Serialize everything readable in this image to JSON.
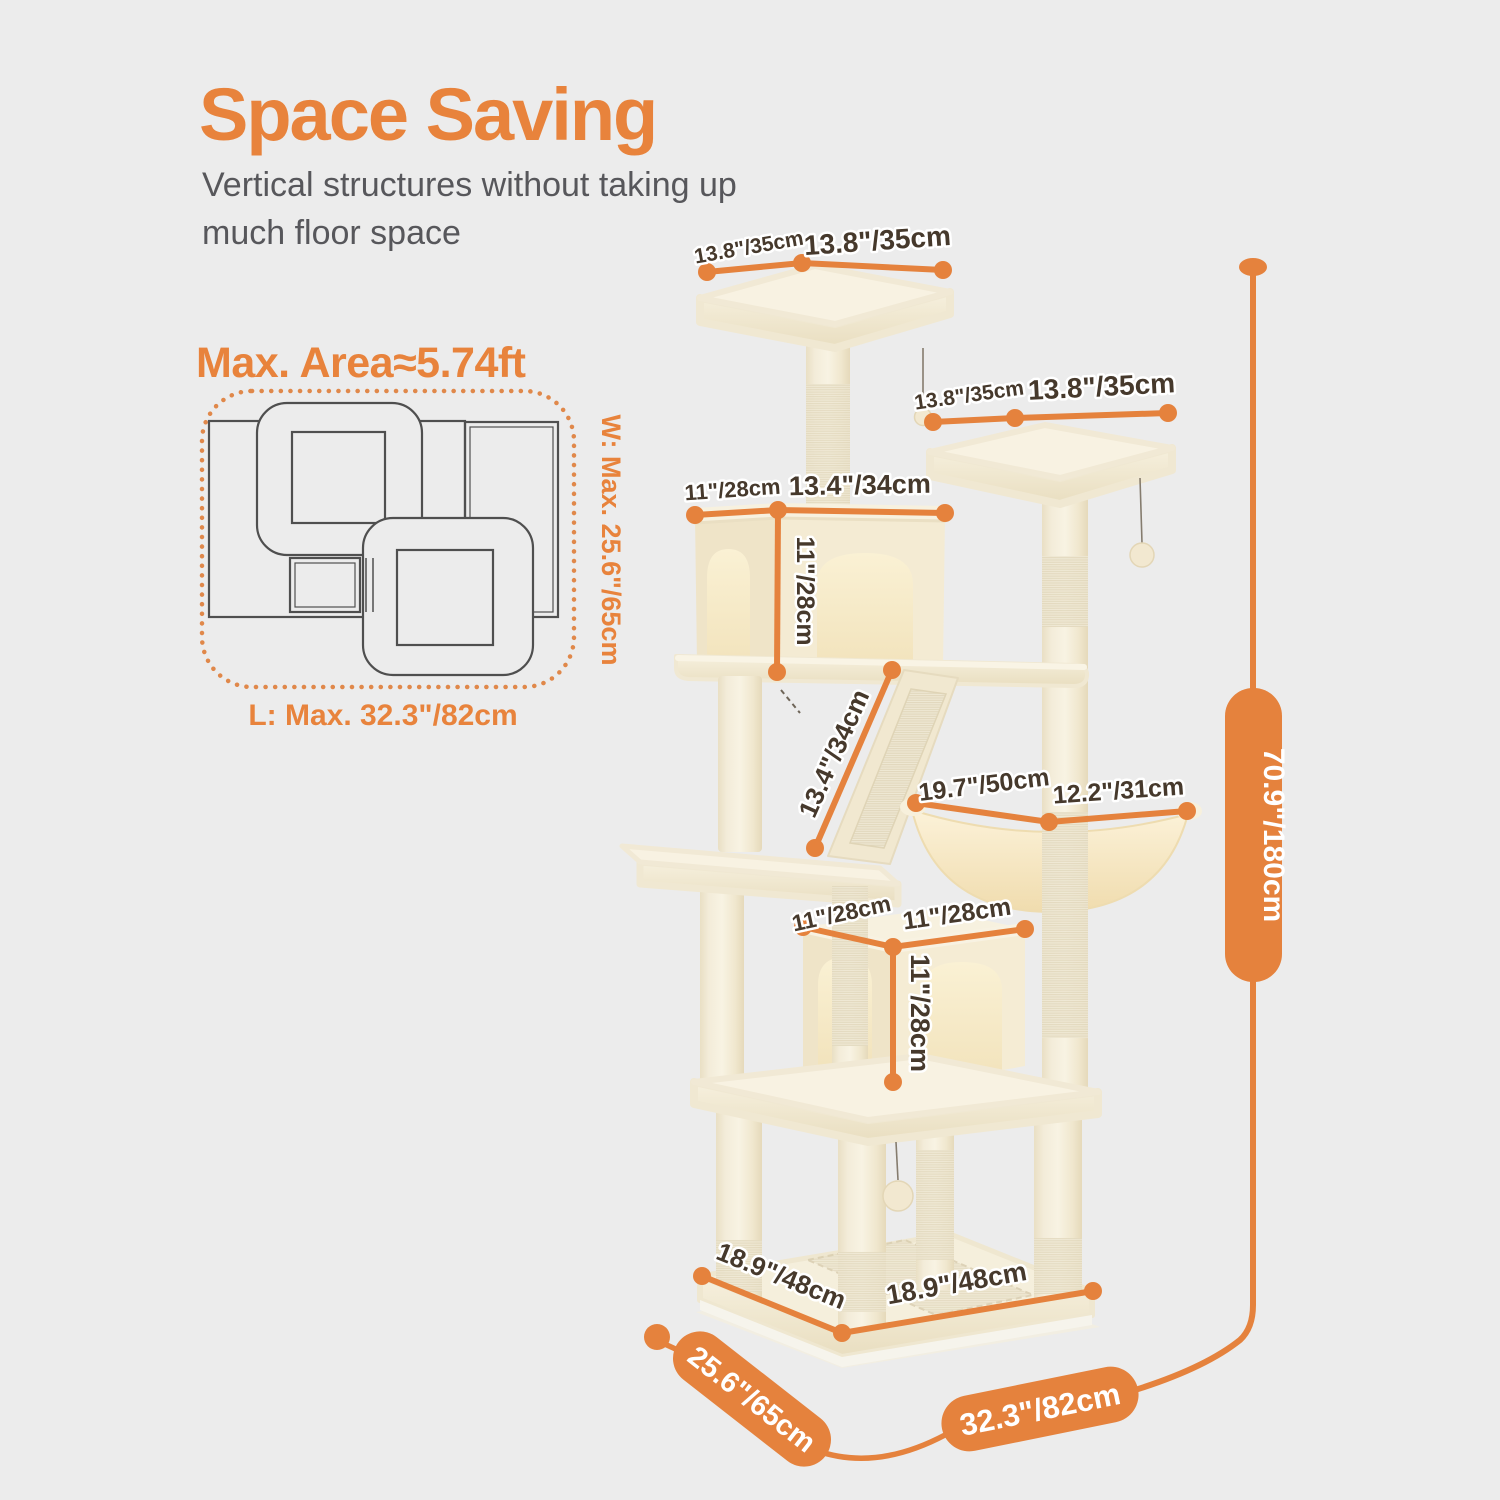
{
  "page": {
    "bg": "#ECECEC",
    "accent": "#E8833C"
  },
  "header": {
    "title": "Space Saving",
    "subtitle_line1": "Vertical structures without taking up",
    "subtitle_line2": "much floor space"
  },
  "area": {
    "title": "Max. Area≈5.74ft",
    "width_label": "W: Max. 25.6\"/65cm",
    "length_label": "L: Max. 32.3\"/82cm"
  },
  "dims": {
    "top_platform": {
      "left": "13.8\"/35cm",
      "right": "13.8\"/35cm"
    },
    "second_platform": {
      "left": "13.8\"/35cm",
      "right": "13.8\"/35cm"
    },
    "upper_condo": {
      "depth": "11\"/28cm",
      "width": "13.4\"/34cm",
      "height": "11\"/28cm"
    },
    "ramp": {
      "length": "13.4\"/34cm"
    },
    "hammock": {
      "width": "19.7\"/50cm",
      "depth": "12.2\"/31cm"
    },
    "lower_condo": {
      "depth": "11\"/28cm",
      "width": "11\"/28cm",
      "height": "11\"/28cm"
    },
    "base": {
      "depth": "18.9\"/48cm",
      "width": "18.9\"/48cm"
    },
    "overall": {
      "depth": "25.6\"/65cm",
      "width": "32.3\"/82cm",
      "height": "70.9\"/180cm"
    }
  }
}
